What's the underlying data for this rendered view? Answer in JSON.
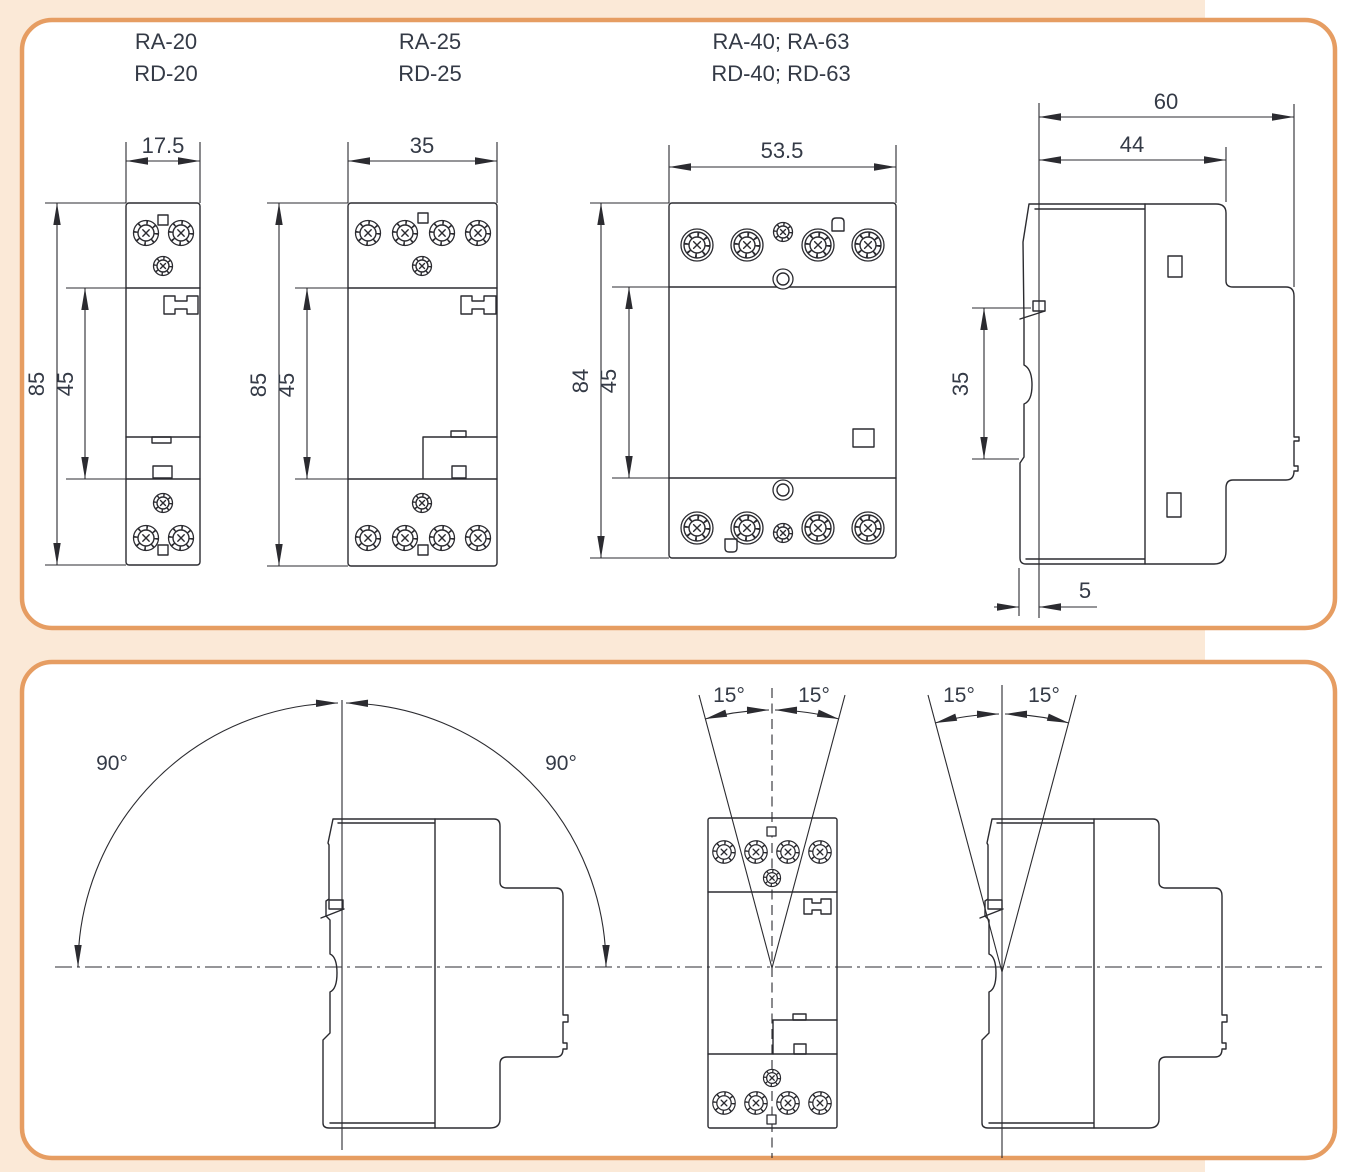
{
  "colors": {
    "accent": "#e69d62",
    "page": "#fbe9d7",
    "panel": "#ffffff",
    "line": "#2b2b30",
    "text": "#343a46"
  },
  "panel1": {
    "models": [
      {
        "line1": "RA-20",
        "line2": "RD-20"
      },
      {
        "line1": "RA-25",
        "line2": "RD-25"
      },
      {
        "line1": "RA-40; RA-63",
        "line2": "RD-40; RD-63"
      }
    ],
    "front1": {
      "width": "17.5",
      "height": "85",
      "inner": "45"
    },
    "front2": {
      "width": "35",
      "height": "85",
      "inner": "45"
    },
    "front3": {
      "width": "53.5",
      "height": "84",
      "inner": "45"
    },
    "side": {
      "total": "60",
      "front": "44",
      "rail": "35",
      "offset": "5"
    }
  },
  "panel2": {
    "rotation": {
      "left": "90°",
      "right": "90°"
    },
    "tilt_front": {
      "left": "15°",
      "right": "15°"
    },
    "tilt_side": {
      "left": "15°",
      "right": "15°"
    }
  }
}
